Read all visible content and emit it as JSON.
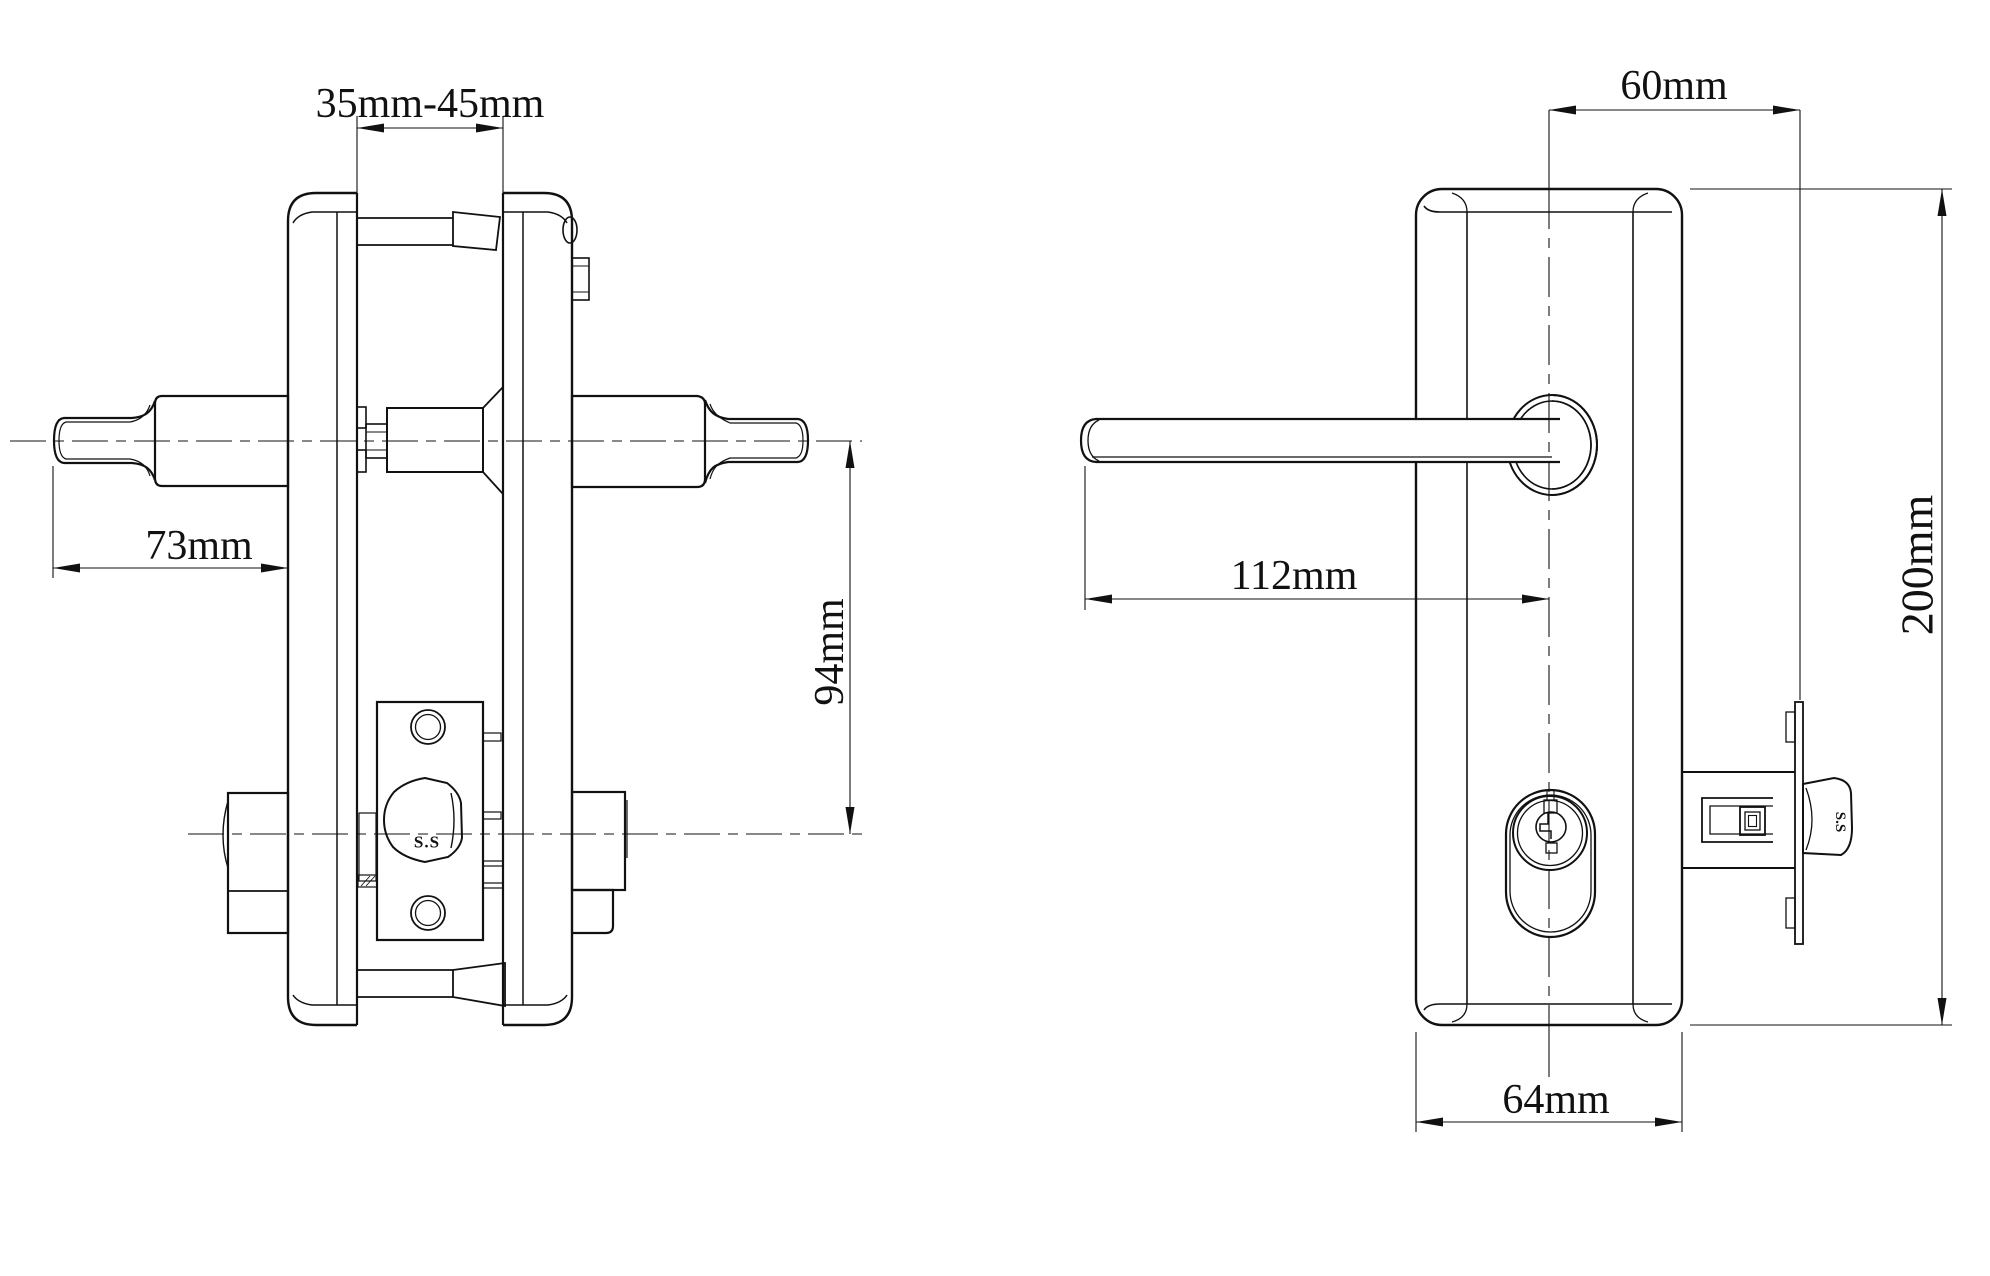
{
  "page": {
    "background": "#ffffff",
    "ink": "#111111"
  },
  "drawing": {
    "dimensions": {
      "door_thickness": "35mm-45mm",
      "outside_handle": "73mm",
      "handle_to_cylinder": "94mm",
      "backset": "60mm",
      "lever_length": "112mm",
      "plate_height": "200mm",
      "plate_width": "64mm"
    },
    "material_marks": {
      "cylinder": "S.S",
      "latch_bolt": "S.S"
    }
  }
}
